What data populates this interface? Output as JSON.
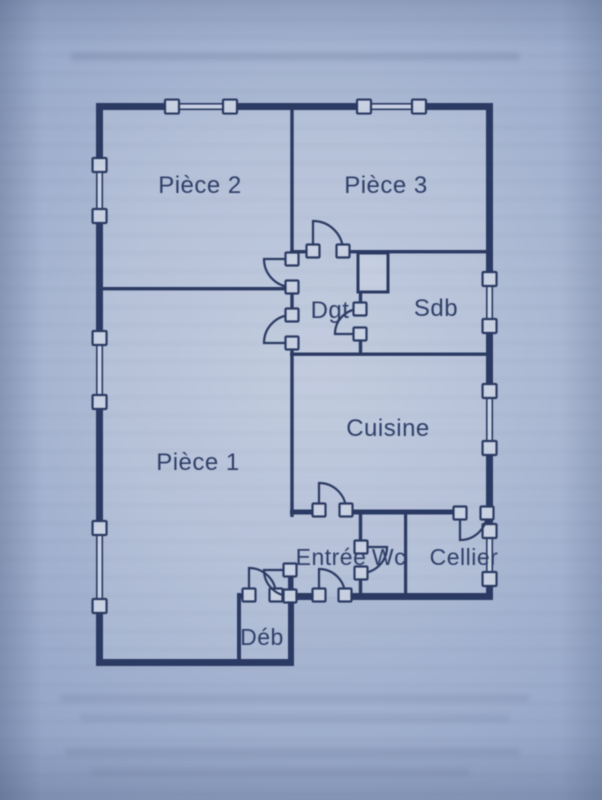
{
  "page": {
    "ink_color": "#2b3a63",
    "text_color": "#303f69",
    "glass_color": "#c9d2e3",
    "paper_bright": "#bcc7dc",
    "paper_dark": "#8a9cc0"
  },
  "floor_plan": {
    "canvas": {
      "width": 602,
      "height": 800
    },
    "rooms": [
      {
        "id": "piece2",
        "label": "Pièce 2",
        "x": 200,
        "y": 193,
        "size": 24
      },
      {
        "id": "piece3",
        "label": "Pièce 3",
        "x": 386,
        "y": 193,
        "size": 24
      },
      {
        "id": "dgt",
        "label": "Dgt",
        "x": 330,
        "y": 318,
        "size": 24
      },
      {
        "id": "sdb",
        "label": "Sdb",
        "x": 436,
        "y": 316,
        "size": 24
      },
      {
        "id": "cuisine",
        "label": "Cuisine",
        "x": 388,
        "y": 436,
        "size": 24
      },
      {
        "id": "piece1",
        "label": "Pièce 1",
        "x": 198,
        "y": 470,
        "size": 24
      },
      {
        "id": "entree",
        "label": "Entrée",
        "x": 331,
        "y": 565,
        "size": 23
      },
      {
        "id": "wc",
        "label": "Wc",
        "x": 389,
        "y": 565,
        "size": 23
      },
      {
        "id": "cellier",
        "label": "Cellier",
        "x": 464,
        "y": 565,
        "size": 23
      },
      {
        "id": "deb",
        "label": "Déb",
        "x": 262,
        "y": 645,
        "size": 23
      }
    ],
    "outline": [
      [
        100,
        106
      ],
      [
        489,
        106
      ],
      [
        489,
        597
      ],
      [
        291,
        597
      ],
      [
        291,
        663
      ],
      [
        100,
        663
      ]
    ],
    "walls": [
      [
        96,
        103,
        76,
        7
      ],
      [
        230,
        103,
        134,
        7
      ],
      [
        419,
        103,
        74,
        7
      ],
      [
        96,
        103,
        7,
        62
      ],
      [
        96,
        216,
        7,
        122
      ],
      [
        96,
        402,
        7,
        126
      ],
      [
        96,
        606,
        7,
        60
      ],
      [
        486,
        103,
        7,
        176
      ],
      [
        486,
        326,
        7,
        65
      ],
      [
        486,
        448,
        7,
        83
      ],
      [
        486,
        579,
        7,
        21
      ],
      [
        290,
        593,
        28,
        7
      ],
      [
        346,
        593,
        146,
        7
      ],
      [
        96,
        659,
        198,
        7
      ],
      [
        288,
        593,
        6,
        72
      ],
      [
        290.3,
        110,
        3.4,
        140
      ],
      [
        290,
        250,
        23,
        3.4
      ],
      [
        343,
        250,
        150,
        3.4
      ],
      [
        103,
        287,
        188,
        3.4
      ],
      [
        290.3,
        253,
        3.4,
        6
      ],
      [
        290.3,
        287,
        3.4,
        28
      ],
      [
        290.3,
        343,
        3.4,
        10
      ],
      [
        358.8,
        292,
        3.4,
        17
      ],
      [
        358.8,
        334,
        3.4,
        19
      ],
      [
        290,
        352.5,
        203,
        3.4
      ],
      [
        290.3,
        355,
        3.4,
        162
      ],
      [
        288,
        572,
        5.5,
        21
      ],
      [
        290,
        509.5,
        28,
        5
      ],
      [
        346,
        509.5,
        113,
        5
      ],
      [
        487,
        509.5,
        6,
        5
      ],
      [
        358.8,
        514,
        3.4,
        32
      ],
      [
        358.8,
        573,
        3.4,
        20
      ],
      [
        404,
        514,
        3.2,
        79
      ],
      [
        237,
        593,
        4,
        73
      ],
      [
        237,
        593.5,
        12,
        5
      ],
      [
        277,
        593.5,
        11,
        5
      ]
    ],
    "closet": [
      358,
      253,
      30,
      39
    ],
    "windows": [
      [
        172,
        103.8,
        58,
        5.5
      ],
      [
        364,
        103.8,
        55,
        5.5
      ],
      [
        96.8,
        165,
        5.5,
        51
      ],
      [
        96.8,
        338,
        5.5,
        64
      ],
      [
        96.8,
        528,
        5.5,
        78
      ],
      [
        486.8,
        279,
        5.5,
        47
      ],
      [
        486.8,
        391,
        5.5,
        57
      ],
      [
        486.8,
        531,
        5.5,
        48
      ]
    ],
    "doors": [
      {
        "id": "door-piece3",
        "hinge": [
          313,
          251
        ],
        "r": 30,
        "leaf": 270,
        "closed": 0,
        "sweep": 1
      },
      {
        "id": "door-piece2",
        "hinge": [
          292,
          259
        ],
        "r": 28,
        "leaf": 180,
        "closed": 90,
        "sweep": 0
      },
      {
        "id": "door-piece1",
        "hinge": [
          292,
          343
        ],
        "r": 28,
        "leaf": 180,
        "closed": 270,
        "sweep": 1
      },
      {
        "id": "door-sdb",
        "hinge": [
          360,
          334
        ],
        "r": 25,
        "leaf": 180,
        "closed": 270,
        "sweep": 1
      },
      {
        "id": "door-cuisine",
        "hinge": [
          319,
          510
        ],
        "r": 27,
        "leaf": 270,
        "closed": 0,
        "sweep": 1
      },
      {
        "id": "door-cellier",
        "hinge": [
          460,
          513
        ],
        "r": 27,
        "leaf": 90,
        "closed": 0,
        "sweep": 0
      },
      {
        "id": "door-wc",
        "hinge": [
          361,
          547
        ],
        "r": 26,
        "leaf": 0,
        "closed": 90,
        "sweep": 1
      },
      {
        "id": "door-entrance",
        "hinge": [
          319,
          595
        ],
        "r": 26,
        "leaf": 270,
        "closed": 0,
        "sweep": 1
      },
      {
        "id": "door-deb",
        "hinge": [
          249,
          595
        ],
        "r": 27,
        "leaf": 270,
        "closed": 0,
        "sweep": 1
      },
      {
        "id": "door-piece1-entree",
        "hinge": [
          290,
          570
        ],
        "r": 26,
        "leaf": 180,
        "closed": 90,
        "sweep": 0
      }
    ]
  }
}
